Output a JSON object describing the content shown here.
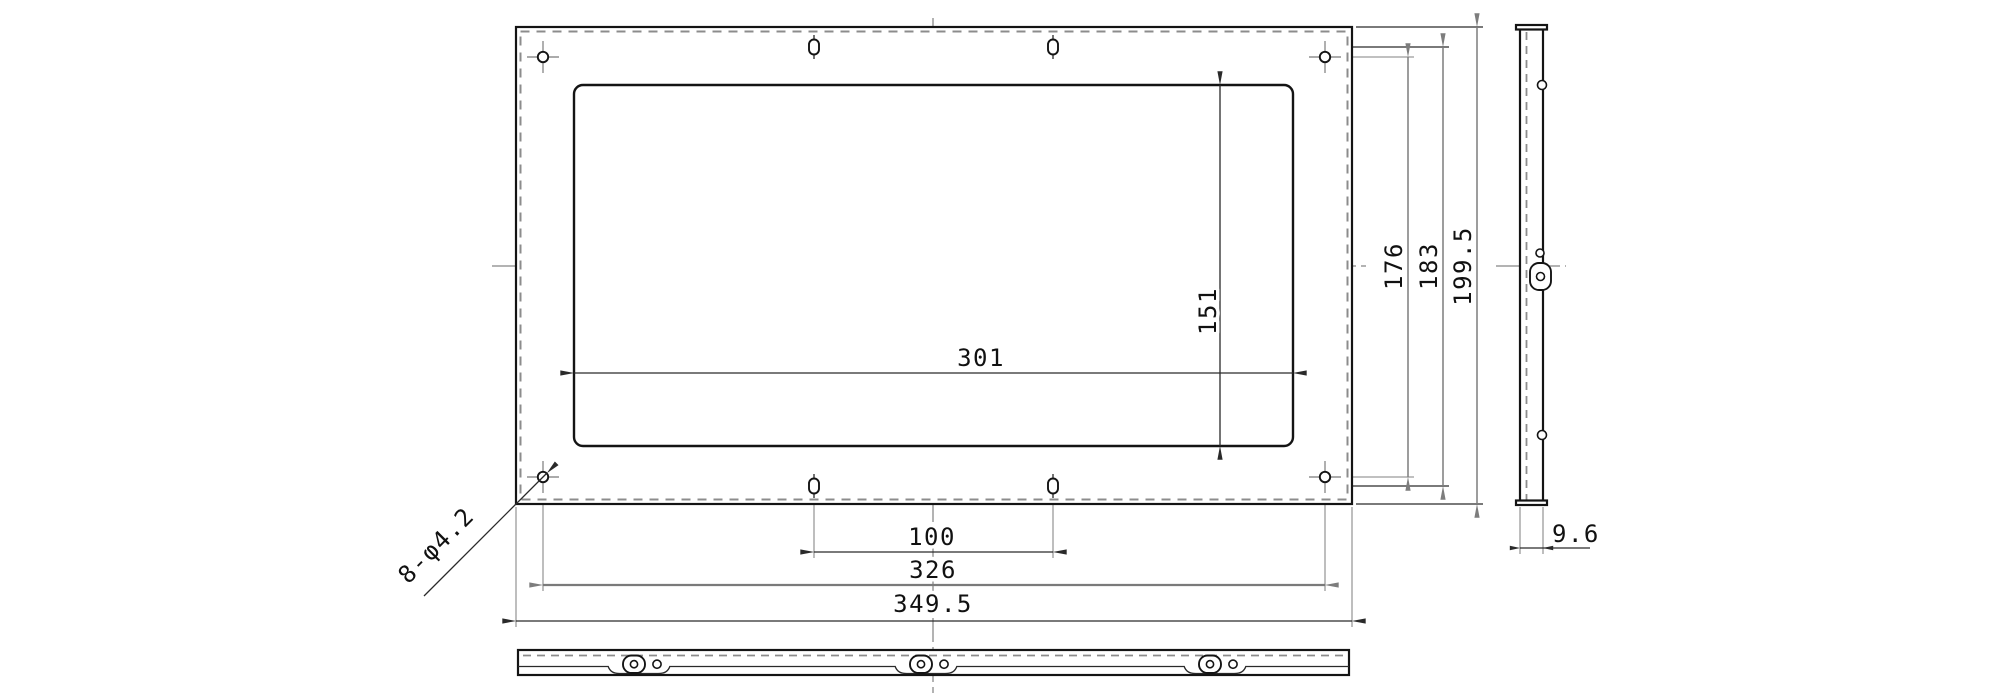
{
  "page": {
    "background": "#ffffff"
  },
  "drawing": {
    "views": {
      "front": {
        "hole_callout": "8-φ4.2",
        "dims": {
          "cutout_width": "301",
          "cutout_height": "151",
          "slot_pitch_h": "100",
          "hole_pitch_h": "326",
          "overall_width": "349.5",
          "hole_pitch_v": "176",
          "slot_pitch_v": "183",
          "overall_height": "199.5"
        }
      },
      "side": {
        "dims": {
          "thickness": "9.6"
        }
      }
    },
    "colors": {
      "geometry": "#141414",
      "dimension_dark": "#2a2a2a",
      "dimension_gray": "#7d7d7d",
      "extension_line": "#9b9b9b",
      "centerline": "#9a9a9a",
      "hidden_line": "#8c8c8c"
    }
  }
}
